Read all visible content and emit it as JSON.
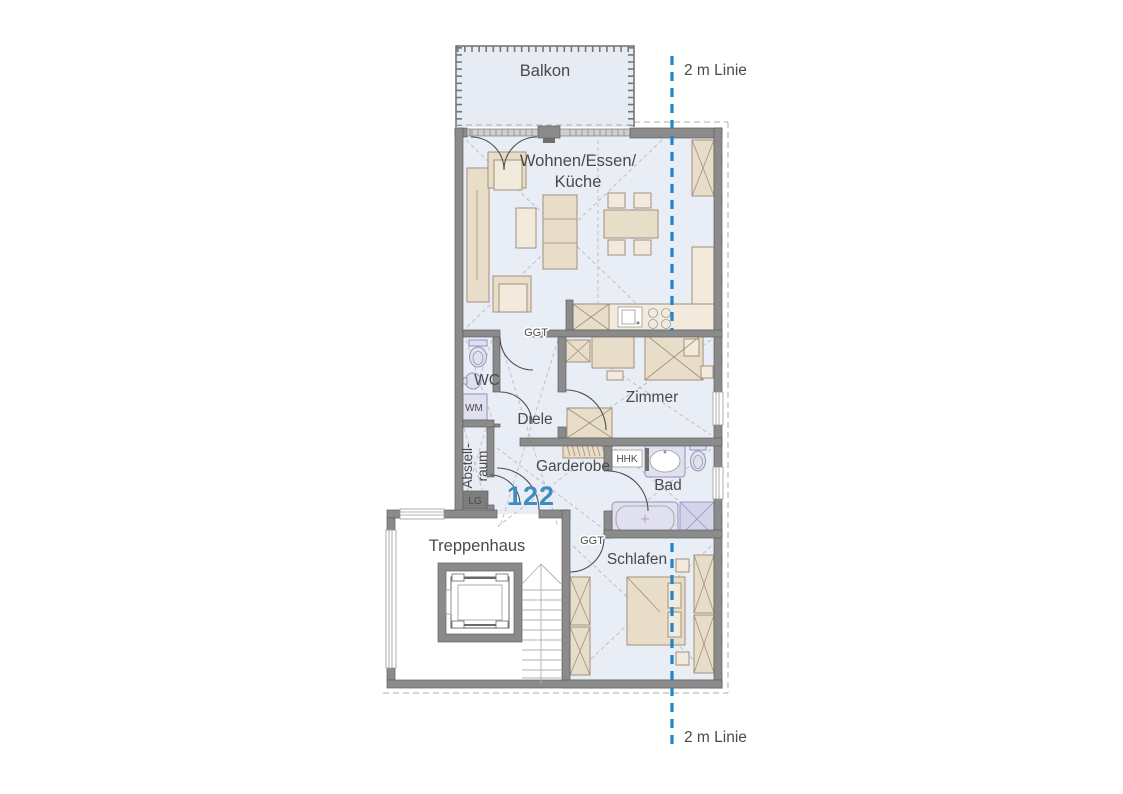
{
  "plan": {
    "unit_number": "122",
    "labels": {
      "balkon": "Balkon",
      "two_m_top": "2 m Linie",
      "two_m_bottom": "2 m Linie",
      "wohnen_line1": "Wohnen/Essen/",
      "wohnen_line2": "Küche",
      "ggt_upper": "GGT",
      "ggt_lower": "GGT",
      "wc": "WC",
      "wm": "WM",
      "diele": "Diele",
      "zimmer": "Zimmer",
      "abstell_line1": "Abstell-",
      "abstell_line2": "raum",
      "lg": "LG",
      "garderobe": "Garderobe",
      "hhk": "HHK",
      "bad": "Bad",
      "schlafen": "Schlafen",
      "treppenhaus": "Treppenhaus"
    },
    "colors": {
      "floor": "#e9edf6",
      "balcony_floor": "#e6ebf4",
      "wall": "#8b8b8b",
      "furniture": "#e8ddc9",
      "fixture": "#e0e0f0",
      "two_m_line": "#1b87c9",
      "unit_number": "#3f8dc0",
      "label_text": "#4a4a4a"
    }
  }
}
